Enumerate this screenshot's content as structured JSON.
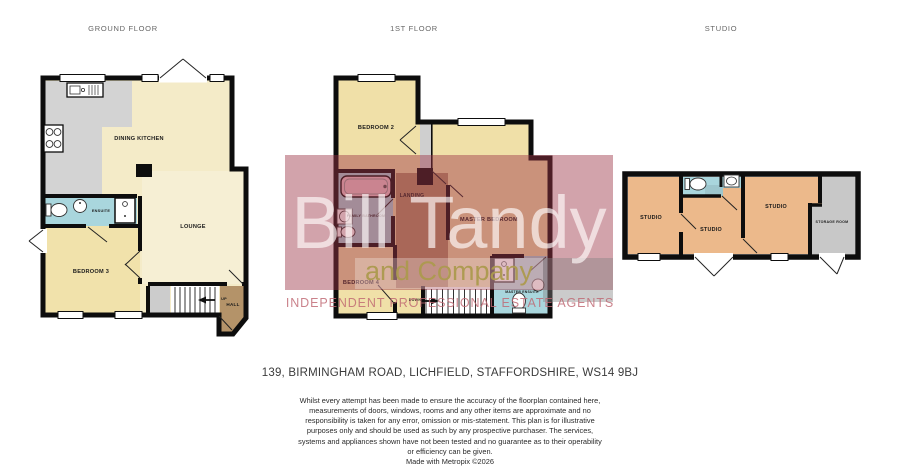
{
  "header": {
    "ground_title": "GROUND FLOOR",
    "first_title": "1ST FLOOR",
    "studio_title": "STUDIO"
  },
  "ground_floor": {
    "dining_kitchen": "DINING KITCHEN",
    "lounge": "LOUNGE",
    "bedroom3": "BEDROOM 3",
    "ensuite": "ENSUITE",
    "hall": "HALL",
    "stairs_direction": "UP"
  },
  "first_floor": {
    "bedroom2": "BEDROOM 2",
    "master_bedroom": "MASTER BEDROOM",
    "landing": "LANDING",
    "family_bathroom": "FAMILY BATHROOM",
    "bedroom4": "BEDROOM 4",
    "master_ensuite": "MASTER ENSUITE",
    "stairs_direction": "DOWN"
  },
  "studio_floor": {
    "studio1": "STUDIO",
    "studio2": "STUDIO",
    "studio3": "STUDIO",
    "storage": "STORAGE ROOM"
  },
  "watermark": {
    "name_line": "Bill Tandy",
    "company_line": "and Company",
    "strapline": "INDEPENDENT PROFESSIONAL ESTATE AGENTS",
    "brand_color": "#9b3345"
  },
  "footer": {
    "address": "139, BIRMINGHAM ROAD, LICHFIELD, STAFFORDSHIRE, WS14 9BJ",
    "disclaimer": "Whilst every attempt has been made to ensure the accuracy of the floorplan contained here, measurements of doors, windows, rooms and any other items are approximate and no responsibility is taken for any error, omission or mis-statement. This plan is for illustrative purposes only and should be used as such by any prospective purchaser. The services, systems and appliances shown have not been tested and no guarantee as to their operability or efficiency can be given.",
    "credit": "Made with Metropix ©2026"
  },
  "colors": {
    "wall": "#0d0d0d",
    "cream_room": "#f4ebc8",
    "warm_room": "#f1e2ab",
    "lounge_room": "#f6efd4",
    "first_floor_room": "#f0e0a8",
    "bathroom_blue": "#a9d6dd",
    "kitchen_gray": "#d3d3d3",
    "storage_gray": "#c8c8c8",
    "hall_brown": "#b49369",
    "studio_orange": "#ecb98b",
    "bath_pink": "#f0c6ce"
  }
}
